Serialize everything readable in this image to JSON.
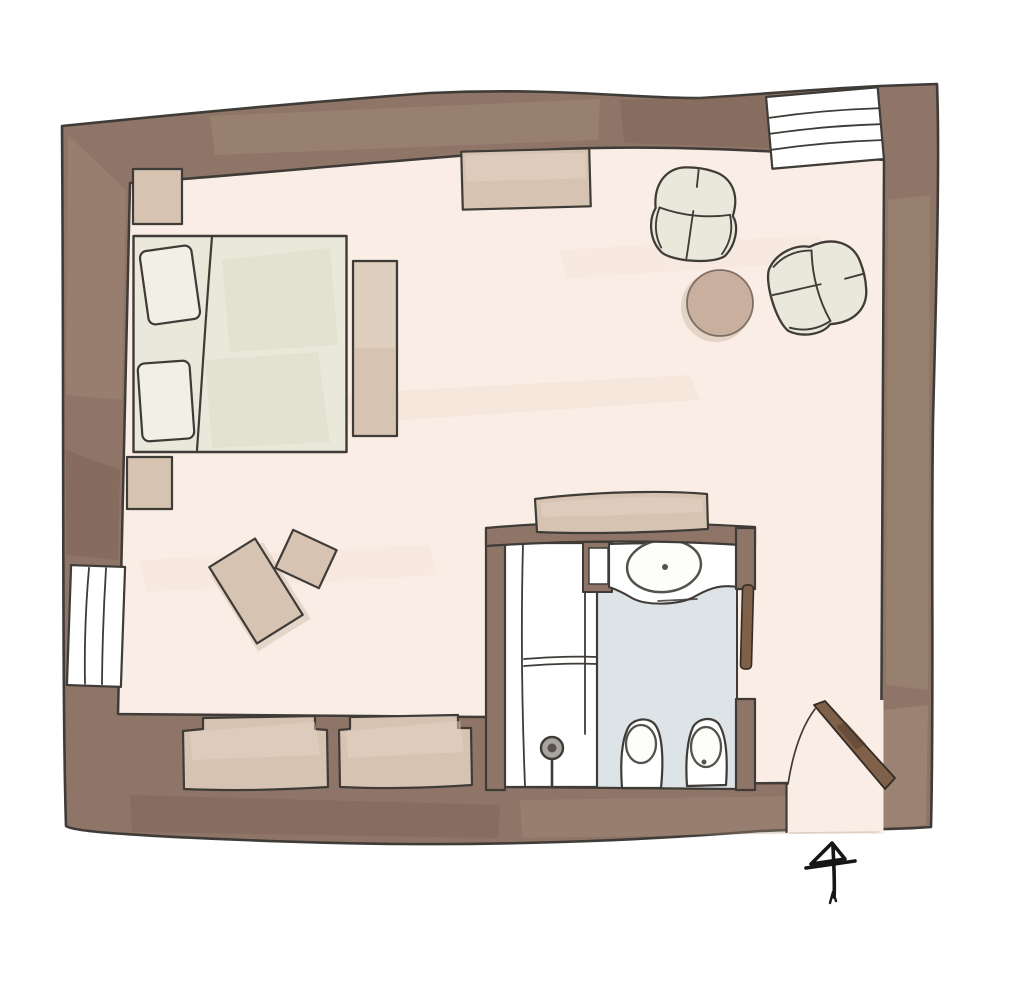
{
  "title": "Hand-drawn watercolor floor plan of a bedroom suite with bathroom",
  "palette": {
    "page": "#FFFFFF",
    "wall": "#8E7567",
    "wall_light": "#A8907E",
    "wall_dark": "#6F5849",
    "outline": "#3F3B37",
    "floor": "#F9EDE5",
    "floor_streak": "#F3DED3",
    "tan": "#D6C3B2",
    "tan_light": "#E4D5C6",
    "tan_deep": "#C9B4A2",
    "sage": "#E9E8DA",
    "sage_shade": "#DEDCCB",
    "pillow": "#F1F0E7",
    "blue": "#DDE4E7",
    "white": "#FFFFFF",
    "table": "#C9B09E",
    "wood": "#7F6149",
    "ink": "#161616"
  },
  "rooms": [
    {
      "id": "bedroom",
      "label": "bedroom"
    },
    {
      "id": "bathroom",
      "label": "bathroom"
    },
    {
      "id": "entry",
      "label": "entry vestibule"
    }
  ],
  "elements": [
    {
      "id": "exterior-walls",
      "label": "thick painted exterior walls"
    },
    {
      "id": "window-left",
      "label": "window in left wall, three panes"
    },
    {
      "id": "window-top-right",
      "label": "window in top wall, four panes"
    },
    {
      "id": "double-bed",
      "label": "double bed with two pillows"
    },
    {
      "id": "nightstand-top",
      "label": "nightstand above bed"
    },
    {
      "id": "nightstand-bottom",
      "label": "nightstand below bed"
    },
    {
      "id": "bench",
      "label": "bench at foot of bed"
    },
    {
      "id": "area-rug-top",
      "label": "small rug at top wall"
    },
    {
      "id": "armchair-1",
      "label": "armchair facing down"
    },
    {
      "id": "armchair-2",
      "label": "armchair facing left"
    },
    {
      "id": "side-table",
      "label": "round side table"
    },
    {
      "id": "pouf-large",
      "label": "large tilted pouf / ottoman"
    },
    {
      "id": "pouf-small",
      "label": "small tilted pouf"
    },
    {
      "id": "wardrobe",
      "label": "wardrobe against bathroom wall"
    },
    {
      "id": "closet-niche-1",
      "label": "built-in closet niche in bottom wall"
    },
    {
      "id": "closet-niche-2",
      "label": "built-in closet niche in bottom wall"
    },
    {
      "id": "shower",
      "label": "walk-in shower with floor drain"
    },
    {
      "id": "vanity-sink",
      "label": "vanity counter with oval basin"
    },
    {
      "id": "toilet",
      "label": "toilet"
    },
    {
      "id": "bidet",
      "label": "bidet"
    },
    {
      "id": "bathroom-door",
      "label": "open bathroom door leaf"
    },
    {
      "id": "entry-door",
      "label": "entry door with swing arc"
    },
    {
      "id": "north-arrow",
      "label": "hand-drawn north arrow"
    }
  ]
}
